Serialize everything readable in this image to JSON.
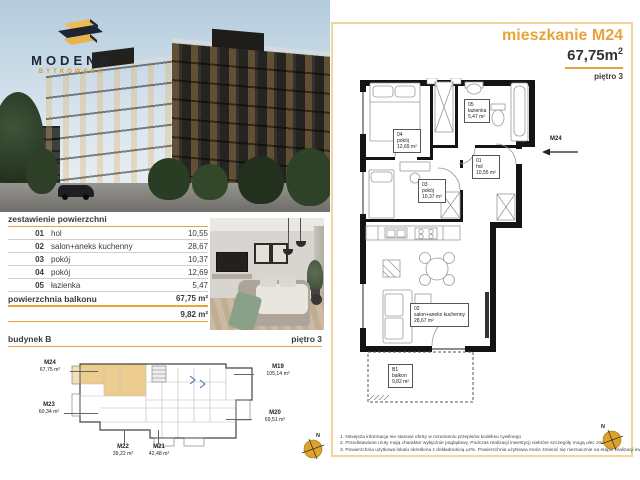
{
  "colors": {
    "accent": "#E8A33C",
    "panel_border": "#F2D49C",
    "dark_text": "#3A3A3A",
    "m24_highlight": "#EBC883"
  },
  "logo": {
    "name": "MODENA",
    "subtitle": "BYTKOWSKA"
  },
  "area_table": {
    "title": "zestawienie powierzchni",
    "rows": [
      {
        "no": "01",
        "name": "hol",
        "value": "10,55"
      },
      {
        "no": "02",
        "name": "salon+aneks kuchenny",
        "value": "28,67"
      },
      {
        "no": "03",
        "name": "pokój",
        "value": "10,37"
      },
      {
        "no": "04",
        "name": "pokój",
        "value": "12,69"
      },
      {
        "no": "05",
        "name": "łazienka",
        "value": "5,47"
      }
    ],
    "total": "67,75 m²"
  },
  "balcony_section": {
    "title": "powierzchnia balkonu",
    "value": "9,82 m²"
  },
  "building_section": {
    "building": "budynek B",
    "floor": "piętro 3",
    "apartments": [
      {
        "id": "M24",
        "area": "67,75 m²"
      },
      {
        "id": "M19",
        "area": "105,14 m²"
      },
      {
        "id": "M23",
        "area": "60,34 m²"
      },
      {
        "id": "M20",
        "area": "69,51 m²"
      },
      {
        "id": "M22",
        "area": "39,22 m²"
      },
      {
        "id": "M21",
        "area": "42,48 m²"
      }
    ]
  },
  "panel": {
    "title": "mieszkanie M24",
    "area": "67,75m",
    "area_sup": "2",
    "floor": "piętro 3",
    "entrance": "M24",
    "rooms": [
      {
        "no": "04",
        "name": "pokój",
        "area": "12,69 m²"
      },
      {
        "no": "05",
        "name": "łazienka",
        "area": "5,47 m²"
      },
      {
        "no": "01",
        "name": "hol",
        "area": "10,55 m²"
      },
      {
        "no": "03",
        "name": "pokój",
        "area": "10,37 m²"
      },
      {
        "no": "02",
        "name": "salon+aneks kuchenny",
        "area": "28,67 m²"
      },
      {
        "no": "B1",
        "name": "balkon",
        "area": "9,82 m²"
      }
    ],
    "disclaimers": [
      "1. Niniejsza informacja nie stanowi oferty w rozumieniu przepisów kodeksu cywilnego",
      "2. Przedstawione rzuty mają charakter wyłącznie poglądowy. Podczas realizacji inwestycji niektóre szczegóły mogą ulec zmianie.",
      "3. Powierzchnia użytkowa lokalu określona z dokładnością ±2%. Powierzchnia użytkowa może zmienić się nieznacznie na etapie realizacji inwestycji."
    ]
  },
  "compass": {
    "label": "N"
  }
}
